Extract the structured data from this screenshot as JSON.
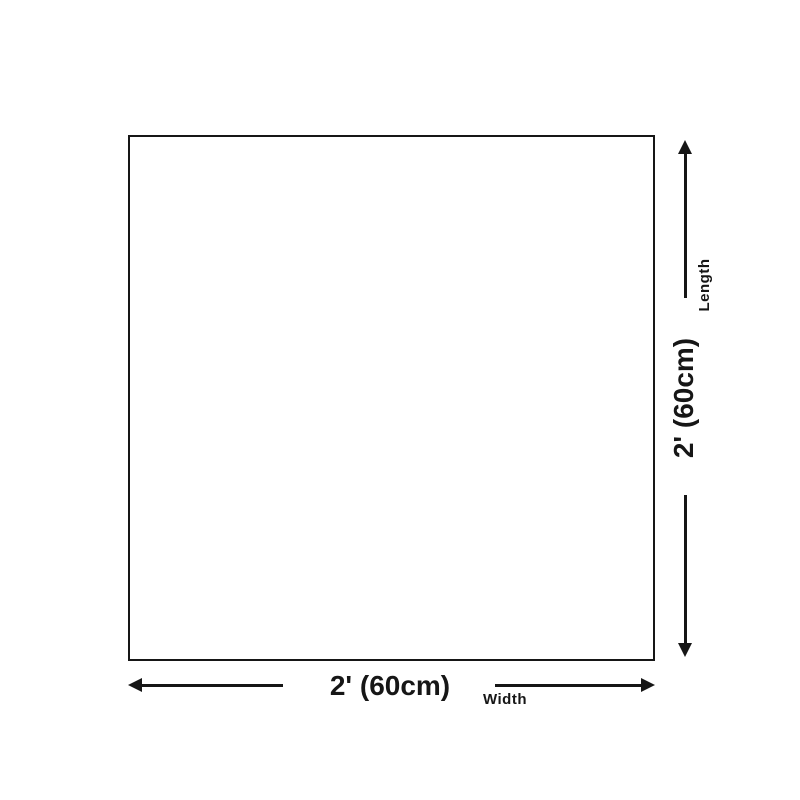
{
  "diagram": {
    "type": "product-dimensions",
    "shape": "square",
    "width_dim": {
      "value": "2' (60cm)",
      "label": "Width",
      "orientation": "horizontal"
    },
    "length_dim": {
      "value": "2' (60cm)",
      "label": "Length",
      "orientation": "vertical"
    },
    "colors": {
      "ink": "#161616",
      "background": "#ffffff"
    }
  }
}
